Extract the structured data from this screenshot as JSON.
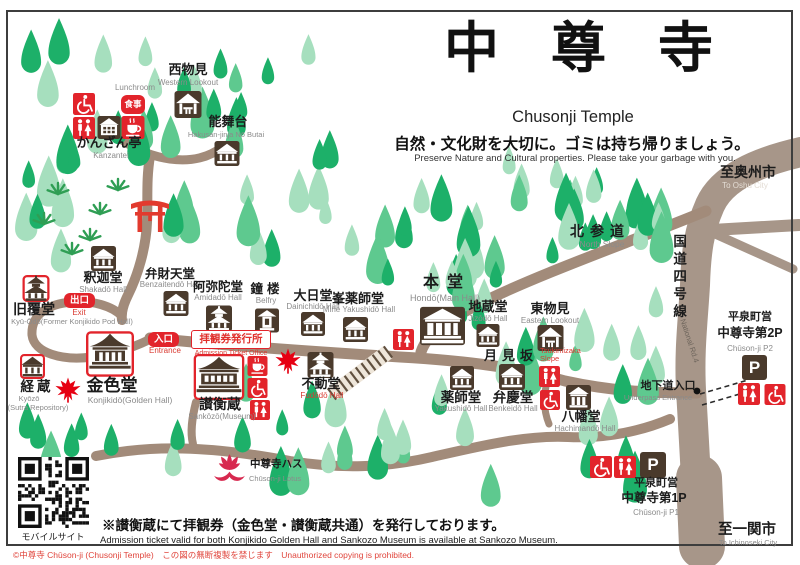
{
  "title": {
    "jp": "中尊寺",
    "en": "Chusonji Temple"
  },
  "notice": {
    "jp": "自然・文化財を大切に。ゴミは持ち帰りましょう。",
    "en": "Preserve Nature and Cultural properties. Please take your garbage with you."
  },
  "footer_notice": {
    "jp": "※讃衡蔵にて拝観券（金色堂・讃衡蔵共通）を発行しております。",
    "en": "Admission ticket valid for both Konjikido Golden Hall and Sankozo Museum is available at Sankozo Museum."
  },
  "copyright": "©中尊寺 Chūson-ji (Chusonji Temple)　この図の無断複製を禁じます　Unauthorized copying is prohibited.",
  "badges": {
    "meal": "食事",
    "exit": "出口",
    "entrance": "入口",
    "parking": "P"
  },
  "places": {
    "lunchroom": {
      "en": "Lunchroom"
    },
    "kanzantei": {
      "jp": "かんざん亭",
      "en": "Kanzantei"
    },
    "western_lookout": {
      "jp": "西物見",
      "en": "Western Lookout"
    },
    "nobutai": {
      "jp": "能舞台",
      "en": "Hakusan-jinja Nō Butai"
    },
    "shakado": {
      "jp": "釈迦堂",
      "en": "Shakadō Hall"
    },
    "benzaitendo": {
      "jp": "弁財天堂",
      "en": "Benzaitendō Hall"
    },
    "amidado": {
      "jp": "阿弥陀堂",
      "en": "Amidadō Hall"
    },
    "belfry": {
      "jp": "鐘楼",
      "en": "Belfry"
    },
    "dainichido": {
      "jp": "大日堂",
      "en": "Dainichidō Hall"
    },
    "mine_yakushido": {
      "jp": "峯薬師堂",
      "en": "Mine Yakushidō Hall"
    },
    "hondo": {
      "jp": "本堂",
      "en": "Hondō(Main Hall)"
    },
    "jizodo": {
      "jp": "地蔵堂",
      "en": "Jizōdō Hall"
    },
    "eastern_lookout": {
      "jp": "東物見",
      "en": "Eastern Lookout"
    },
    "north_slope": {
      "jp": "北参道",
      "en": "North Slope"
    },
    "kyu_odo": {
      "jp": "旧覆堂",
      "en": "Kyū-Ōdō(Former Konjikido Pod Hall)"
    },
    "kyozo": {
      "jp": "経蔵",
      "en": "Kyōzō",
      "en2": "(Sutra Repository)"
    },
    "konjikido": {
      "jp": "金色堂",
      "en": "Konjikidō(Golden Hall)"
    },
    "sankozo": {
      "jp": "讃衡蔵",
      "en": "Sankōzō(Museum)"
    },
    "ticket_office": {
      "jp": "拝観券発行所",
      "en": "Admission Ticket Office"
    },
    "exit": {
      "en": "Exit"
    },
    "entrance": {
      "en": "Entrance"
    },
    "fudodo": {
      "jp": "不動堂",
      "en": "Fudōdō Hall"
    },
    "yakushido": {
      "jp": "薬師堂",
      "en": "Yakushidō Hall"
    },
    "benkeido": {
      "jp": "弁慶堂",
      "en": "Benkeidō Hall"
    },
    "hachimando": {
      "jp": "八幡堂",
      "en": "Hachimandō Hall"
    },
    "tsukimizaka": {
      "jp": "月見坂",
      "en": "Tsukimizaka\nSlope"
    },
    "route4": {
      "jp": "国道四号線",
      "en": "National Rd.4"
    },
    "to_oshu": {
      "jp": "至奥州市",
      "en": "To Oshu City"
    },
    "to_ichinoseki": {
      "jp": "至一関市",
      "en": "To Ichinoseki City"
    },
    "p2": {
      "jp": "平泉町営",
      "jp2": "中尊寺第2P",
      "en": "Chūson-ji P2"
    },
    "p1": {
      "jp": "平泉町営",
      "jp2": "中尊寺第1P",
      "en": "Chūson-ji P1"
    },
    "underpass": {
      "jp": "地下道入口",
      "en": "Underpass Entrance"
    },
    "lotus": {
      "jp": "中尊寺ハス",
      "en": "Chūson-ji Lotus"
    },
    "mobile": {
      "jp": "モバイルサイト"
    }
  },
  "colors": {
    "tree_dark": "#1db069",
    "tree_light": "#a6dfbe",
    "tree_mid": "#5ec98f",
    "path": "#a28b7a",
    "road": "#a79689",
    "icon_brown": "#4a3a2c",
    "red": "#e2242b",
    "label_red": "#d93a31",
    "torii_red": "#e23a2e",
    "maple_red": "#e60012",
    "lotus_red": "#d7294f",
    "gray": "#8b8b8b"
  }
}
